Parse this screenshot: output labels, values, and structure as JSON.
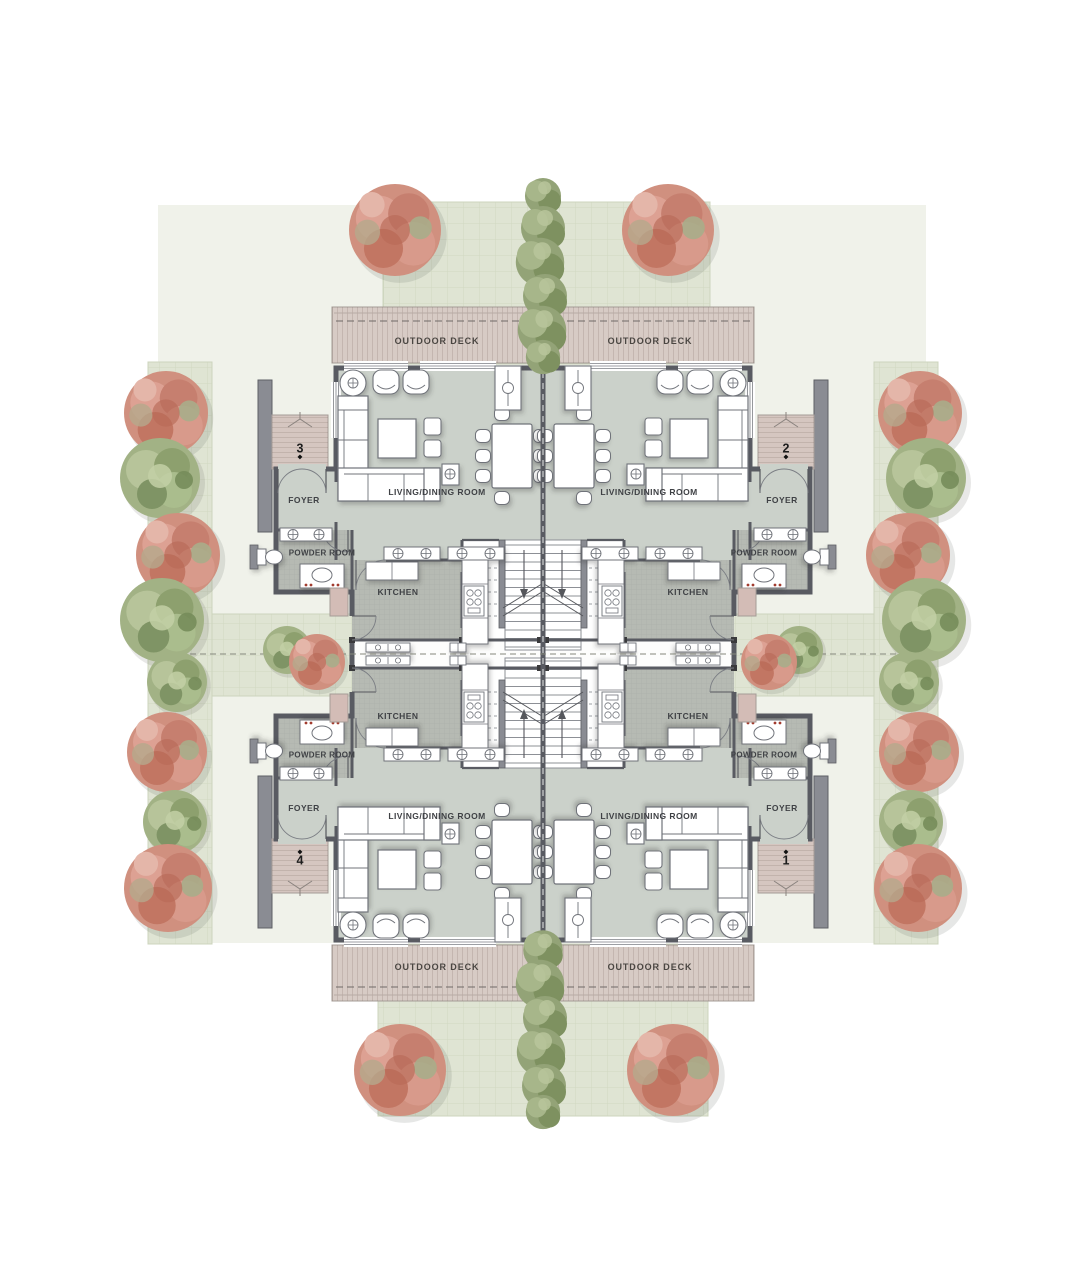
{
  "page": {
    "type": "architectural floor plan, four-unit residence, ground level"
  },
  "labels": {
    "outdoor_deck": "OUTDOOR DECK",
    "living_dining_room": "LIVING/DINING ROOM",
    "foyer": "FOYER",
    "powder_room": "POWDER ROOM",
    "kitchen": "KITCHEN"
  },
  "units": [
    {
      "number": "1",
      "position": "bottom-right"
    },
    {
      "number": "2",
      "position": "top-right"
    },
    {
      "number": "3",
      "position": "top-left"
    },
    {
      "number": "4",
      "position": "bottom-left"
    }
  ],
  "icons": {
    "unit_marker": "diamond-pin-icon",
    "column_register": "crosshair-circle-icon",
    "stair_arrow": "direction-arrow-icon"
  },
  "palette": {
    "floor": "#cbd1ca",
    "kfloor": "#b6bab3",
    "wall": "#595b62",
    "wall2": "#8a8c93",
    "deck": "#d7cbc5",
    "porch": "#d5c6c0",
    "path": "#dfe4d3",
    "plaza": "#f0f2ea",
    "hedge": "#93a377",
    "treePink": "#d0907f",
    "treeGreen": "#a2b285",
    "outline": "#70737a",
    "text": "#3f4145",
    "accentRed": "#a23b2e"
  }
}
